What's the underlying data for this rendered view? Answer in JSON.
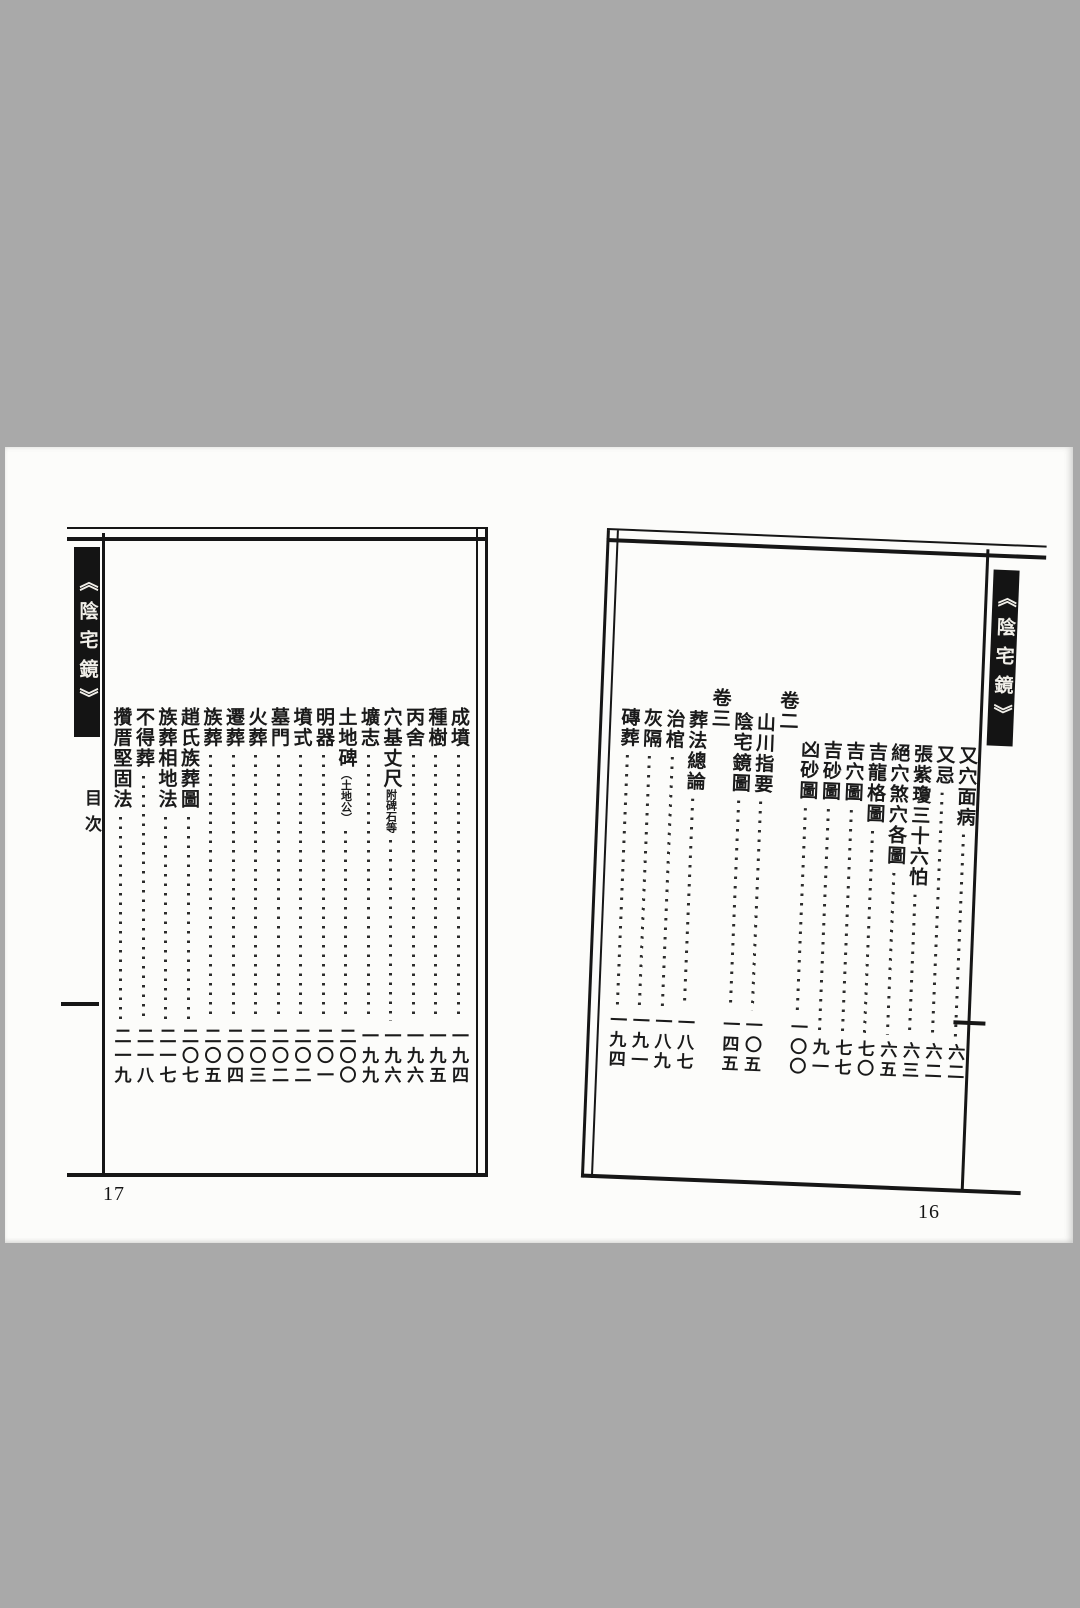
{
  "colors": {
    "background": "#a9a9a9",
    "paper": "#fcfcfa",
    "ink": "#161616",
    "strip_bg": "#141414",
    "strip_text": "#f1efe9"
  },
  "book_title": "《陰宅鏡》",
  "left_page": {
    "page_number_label": "17",
    "title_strip": "《陰宅鏡》",
    "subtitle": "目次",
    "entries": [
      {
        "title": "成墳",
        "page": "一九四",
        "level": 1
      },
      {
        "title": "種樹",
        "page": "一九五",
        "level": 1
      },
      {
        "title": "丙舍",
        "page": "一九六",
        "level": 1
      },
      {
        "title": "穴基丈尺",
        "note": "附碑石等",
        "page": "一九六",
        "level": 1
      },
      {
        "title": "壙志",
        "page": "一九九",
        "level": 1
      },
      {
        "title": "土地碑",
        "note": "（土地公）",
        "page": "二〇〇",
        "level": 1
      },
      {
        "title": "明器",
        "page": "二〇一",
        "level": 1
      },
      {
        "title": "墳式",
        "page": "二〇二",
        "level": 1
      },
      {
        "title": "墓門",
        "page": "二〇二",
        "level": 1
      },
      {
        "title": "火葬",
        "page": "二〇三",
        "level": 1
      },
      {
        "title": "遷葬",
        "page": "二〇四",
        "level": 1
      },
      {
        "title": "族葬",
        "page": "二〇五",
        "level": 1
      },
      {
        "title": "趙氏族葬圖",
        "page": "二〇七",
        "level": 1
      },
      {
        "title": "族葬相地法",
        "page": "二一七",
        "level": 1
      },
      {
        "title": "不得葬",
        "page": "二一八",
        "level": 1
      },
      {
        "title": "攢厝堅固法",
        "page": "二一九",
        "level": 1
      }
    ]
  },
  "right_page": {
    "page_number_label": "16",
    "title_strip": "《陰宅鏡》",
    "entries": [
      {
        "title": "又穴面病",
        "page": "六二",
        "level": 2
      },
      {
        "title": "又忌",
        "page": "六二",
        "level": 2
      },
      {
        "title": "張紫瓊三十六怕",
        "page": "六三",
        "level": 2
      },
      {
        "title": "絕穴煞穴各圖",
        "page": "六五",
        "level": 2
      },
      {
        "title": "吉龍格圖",
        "page": "七〇",
        "level": 2
      },
      {
        "title": "吉穴圖",
        "page": "七七",
        "level": 2
      },
      {
        "title": "吉砂圖",
        "page": "九一",
        "level": 2
      },
      {
        "title": "凶砂圖",
        "page": "一〇〇",
        "level": 2
      },
      {
        "title": "卷二",
        "page": "",
        "level": 0
      },
      {
        "title": "山川指要",
        "page": "一〇五",
        "level": 1
      },
      {
        "title": "陰宅鏡圖",
        "page": "一四五",
        "level": 1
      },
      {
        "title": "卷三",
        "page": "",
        "level": 0
      },
      {
        "title": "葬法總論",
        "page": "一八七",
        "level": 1
      },
      {
        "title": "治棺",
        "page": "一八九",
        "level": 1
      },
      {
        "title": "灰隔",
        "page": "一九一",
        "level": 1
      },
      {
        "title": "磚葬",
        "page": "一九四",
        "level": 1
      }
    ]
  }
}
